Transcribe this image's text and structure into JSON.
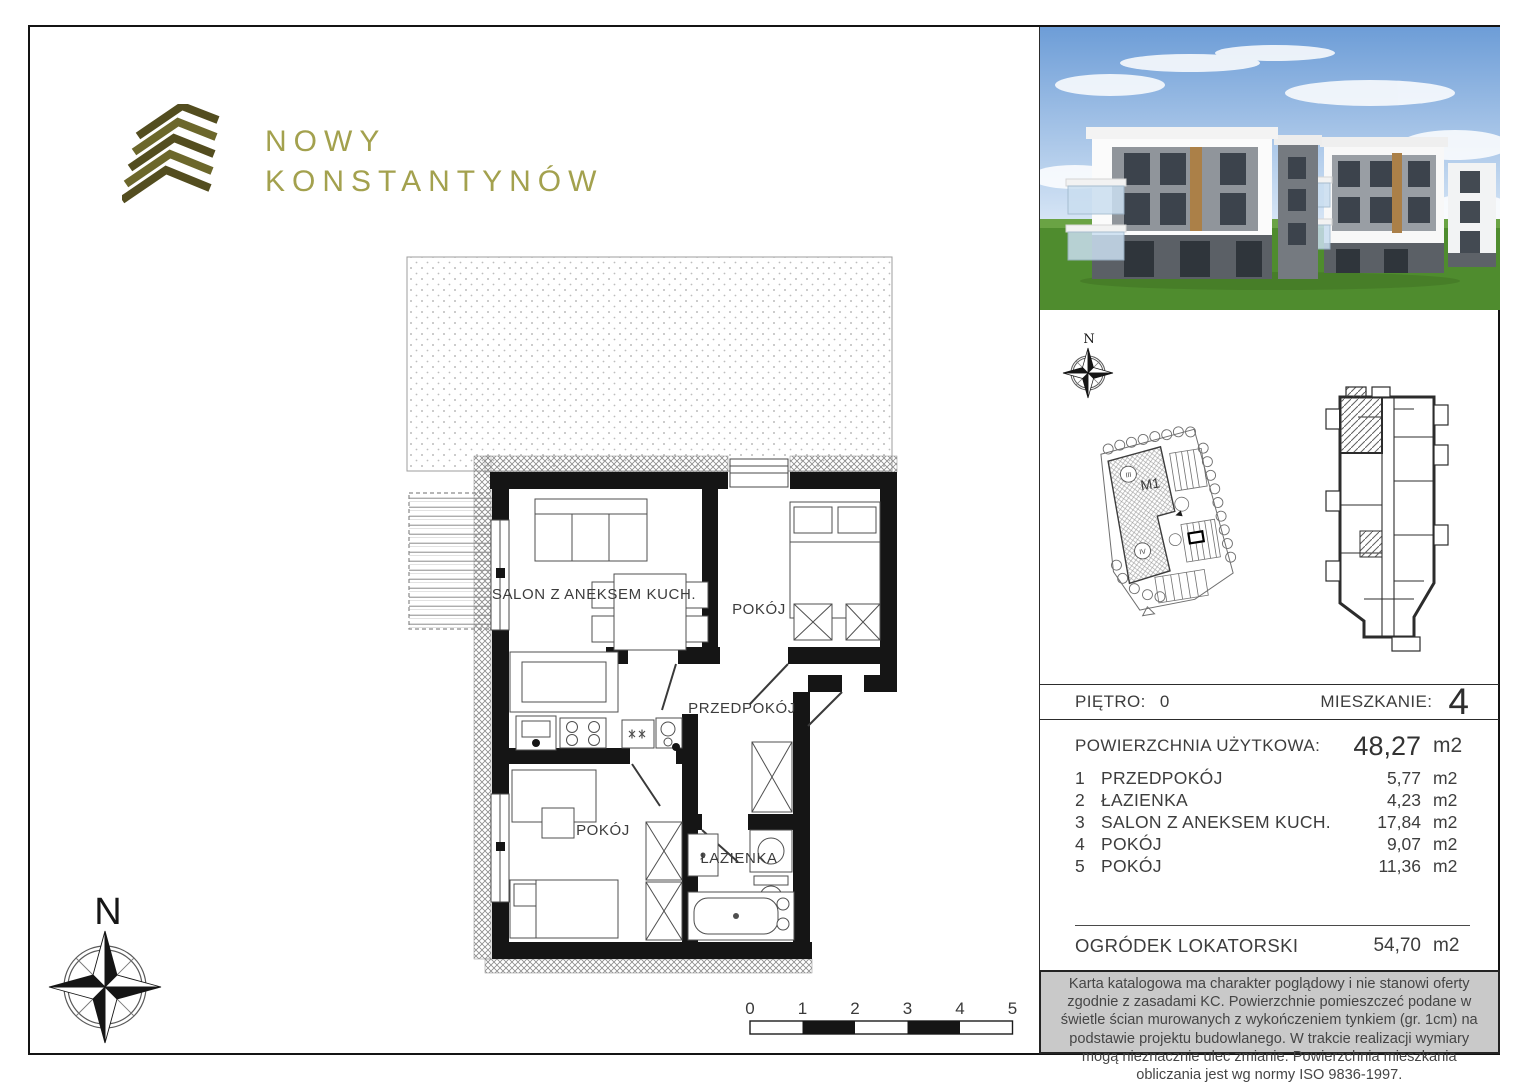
{
  "logo": {
    "line1": "NOWY",
    "line2": "KONSTANTYNÓW"
  },
  "colors": {
    "logo_mark_dark": "#534d1f",
    "logo_mark_light": "#6c672b",
    "logo_text": "#a3a14e",
    "disclaimer_bg": "#c9c9c9",
    "wall": "#151515"
  },
  "floor_plan": {
    "rooms": {
      "salon": "SALON Z ANEKSEM KUCH.",
      "pokoj_top": "POKÓJ",
      "przedpokoj": "PRZEDPOKÓJ",
      "pokoj_bottom": "POKÓJ",
      "lazienka": "ŁAZIENKA"
    },
    "compass_label": "N"
  },
  "scale_bar": {
    "ticks": [
      "0",
      "1",
      "2",
      "3",
      "4",
      "5"
    ]
  },
  "site_plan": {
    "compass_label": "N",
    "building_label": "M1",
    "unit_iii": "III",
    "unit_iv": "IV"
  },
  "details": {
    "floor_label": "PIĘTRO:",
    "floor_value": "0",
    "apartment_label": "MIESZKANIE:",
    "apartment_value": "4",
    "area_label": "POWIERZCHNIA UŻYTKOWA:",
    "area_value": "48,27",
    "area_unit": "m2",
    "rooms": [
      {
        "no": "1",
        "name": "PRZEDPOKÓJ",
        "area": "5,77",
        "unit": "m2"
      },
      {
        "no": "2",
        "name": "ŁAZIENKA",
        "area": "4,23",
        "unit": "m2"
      },
      {
        "no": "3",
        "name": "SALON Z ANEKSEM KUCH.",
        "area": "17,84",
        "unit": "m2"
      },
      {
        "no": "4",
        "name": "POKÓJ",
        "area": "9,07",
        "unit": "m2"
      },
      {
        "no": "5",
        "name": "POKÓJ",
        "area": "11,36",
        "unit": "m2"
      }
    ],
    "garden_label": "OGRÓDEK LOKATORSKI",
    "garden_value": "54,70",
    "garden_unit": "m2"
  },
  "disclaimer": "Karta katalogowa ma charakter poglądowy i nie stanowi oferty zgodnie z zasadami KC. Powierzchnie pomieszczeć podane w świetle ścian murowanych z wykończeniem tynkiem (gr. 1cm) na podstawie projektu budowlanego. W trakcie realizacji wymiary mogą nieznacznie ulec zmianie. Powierzchnia mieszkania obliczania jest wg normy ISO 9836-1997."
}
